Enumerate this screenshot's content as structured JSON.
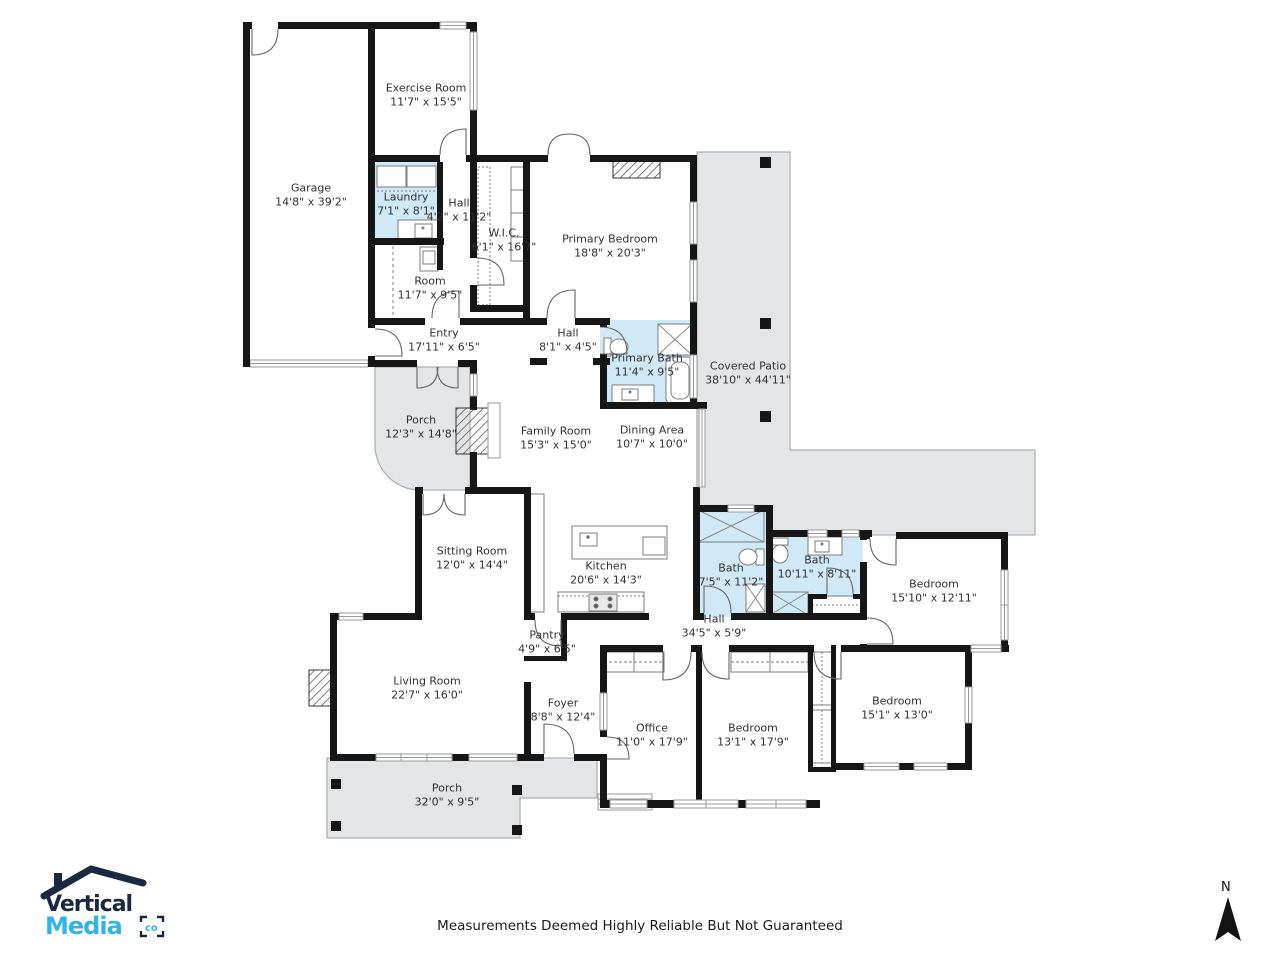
{
  "meta": {
    "disclaimer": "Measurements Deemed Highly Reliable But Not Guaranteed",
    "compass_label": "N"
  },
  "logo": {
    "line1": "Vertical",
    "line2": "Media",
    "suffix": "co"
  },
  "colors": {
    "wall": "#161616",
    "bath_fill": "#cfe9f7",
    "patio_fill": "#e4e5e6",
    "logo_navy": "#1a2940",
    "logo_cyan": "#2fb5e3"
  },
  "rooms": [
    {
      "id": "garage",
      "name": "Garage",
      "dims": "14'8\" x 39'2\""
    },
    {
      "id": "exercise-room",
      "name": "Exercise Room",
      "dims": "11'7\" x 15'5\""
    },
    {
      "id": "laundry",
      "name": "Laundry",
      "dims": "7'1\" x 8'1\""
    },
    {
      "id": "hall-a",
      "name": "Hall",
      "dims": "4'2\" x 11'2\""
    },
    {
      "id": "wic",
      "name": "W.I.C.",
      "dims": "6'1\" x 16'7\""
    },
    {
      "id": "primary-bedroom",
      "name": "Primary Bedroom",
      "dims": "18'8\" x 20'3\""
    },
    {
      "id": "room",
      "name": "Room",
      "dims": "11'7\" x 9'5\""
    },
    {
      "id": "entry",
      "name": "Entry",
      "dims": "17'11\" x 6'5\""
    },
    {
      "id": "hall-b",
      "name": "Hall",
      "dims": "8'1\" x 4'5\""
    },
    {
      "id": "primary-bath",
      "name": "Primary Bath",
      "dims": "11'4\" x 9'5\""
    },
    {
      "id": "covered-patio",
      "name": "Covered Patio",
      "dims": "38'10\" x 44'11\""
    },
    {
      "id": "porch-rear",
      "name": "Porch",
      "dims": "12'3\" x 14'8\""
    },
    {
      "id": "family-room",
      "name": "Family Room",
      "dims": "15'3\" x 15'0\""
    },
    {
      "id": "dining-area",
      "name": "Dining Area",
      "dims": "10'7\" x 10'0\""
    },
    {
      "id": "sitting-room",
      "name": "Sitting Room",
      "dims": "12'0\" x 14'4\""
    },
    {
      "id": "kitchen",
      "name": "Kitchen",
      "dims": "20'6\" x 14'3\""
    },
    {
      "id": "bath-a",
      "name": "Bath",
      "dims": "7'5\" x 11'2\""
    },
    {
      "id": "bath-b",
      "name": "Bath",
      "dims": "10'11\" x 8'11\""
    },
    {
      "id": "bedroom-a",
      "name": "Bedroom",
      "dims": "15'10\" x 12'11\""
    },
    {
      "id": "hall-c",
      "name": "Hall",
      "dims": "34'5\" x 5'9\""
    },
    {
      "id": "pantry",
      "name": "Pantry",
      "dims": "4'9\" x 6'5\""
    },
    {
      "id": "living-room",
      "name": "Living Room",
      "dims": "22'7\" x 16'0\""
    },
    {
      "id": "bedroom-b",
      "name": "Bedroom",
      "dims": "15'1\" x 13'0\""
    },
    {
      "id": "foyer",
      "name": "Foyer",
      "dims": "8'8\" x 12'4\""
    },
    {
      "id": "office",
      "name": "Office",
      "dims": "11'0\" x 17'9\""
    },
    {
      "id": "bedroom-c",
      "name": "Bedroom",
      "dims": "13'1\" x 17'9\""
    },
    {
      "id": "porch-front",
      "name": "Porch",
      "dims": "32'0\" x 9'5\""
    }
  ]
}
